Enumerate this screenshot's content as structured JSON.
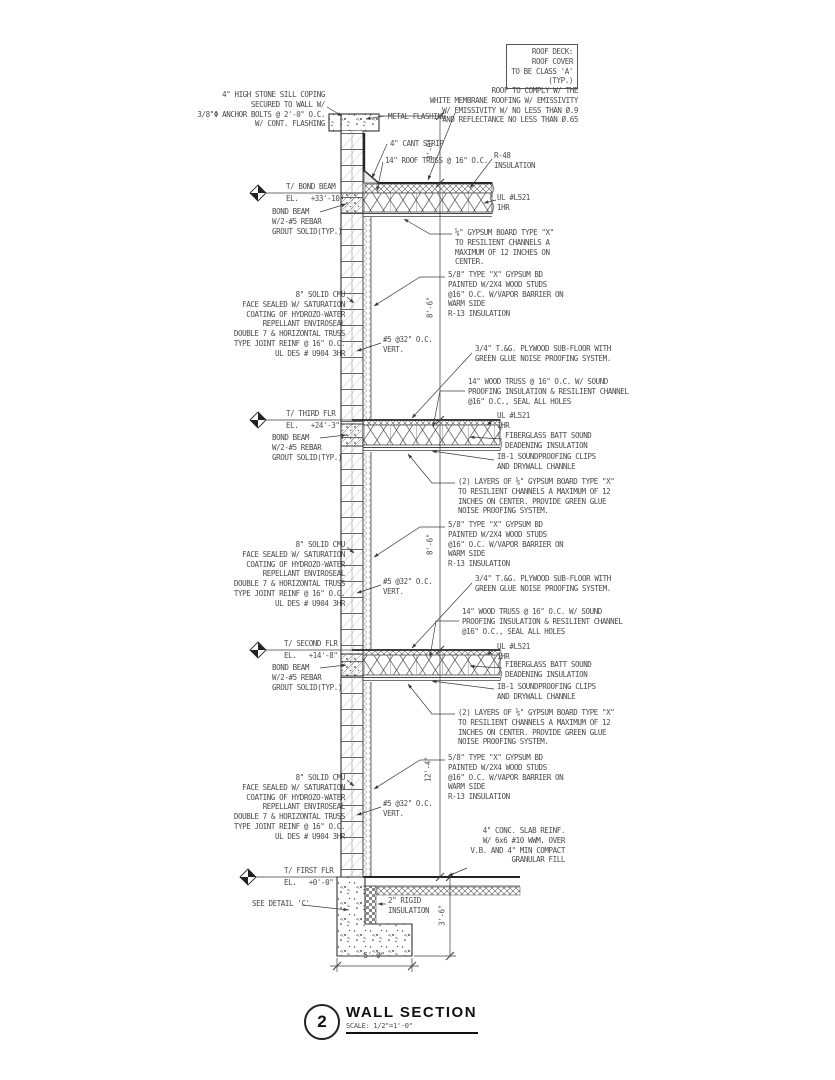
{
  "title_block": {
    "number": "2",
    "title": "WALL SECTION",
    "scale": "SCALE: 1/2\"=1'-0\""
  },
  "notes": {
    "roof_deck_box": "ROOF DECK:\nROOF COVER\nTO BE CLASS 'A'\n(TYP.)",
    "roof_comply": "ROOF TO COMPLY W/ THE\nWHITE MEMBRANE ROOFING W/ EMISSIVITY\nW/ EMISSIVITY W/ NO LESS THAN Ø.9\nAND REFLECTANCE NO LESS THAN Ø.65",
    "stone_sill": "4\" HIGH STONE SILL COPING\nSECURED TO WALL W/\n3/8\"Φ ANCHOR BOLTS @ 2'-0\" O.C.\nW/ CONT. FLASHING",
    "metal_flashing": "METAL FLASHING",
    "cant_strip": "4\" CANT STRIP",
    "roof_truss": "14\" ROOF TRUSS @ 16\" O.C.",
    "r48_insulation": "R-48\nINSULATION",
    "ul_rating": "UL #L521\n1HR",
    "gypsum_resilient": "⅝\" GYPSUM BOARD TYPE \"X\"\nTO RESILIENT CHANNELS A\nMAXIMUM OF 12 INCHES ON\nCENTER.",
    "gypsum_bd": "5/8\" TYPE \"X\" GYPSUM BD\nPAINTED W/2X4 WOOD STUDS\n@16\" O.C. W/VAPOR BARRIER ON\nWARM SIDE\nR-13 INSULATION",
    "cmu_wall": "8\" SOLID CMU\nFACE SEALED W/ SATURATION\nCOATING OF HYDROZO-WATER\nREPELLANT ENVIROSEAL\nDOUBLE 7 & HORIZONTAL TRUSS\nTYPE JOINT REINF @ 16\" O.C.\nUL DES # U904 3HR",
    "vert_rebar": "#5 @32\" O.C.\nVERT.",
    "plywood_subfloor": "3/4\" T.&G. PLYWOOD SUB-FLOOR WITH\nGREEN GLUE NOISE PROOFING SYSTEM.",
    "wood_truss": "14\" WOOD TRUSS @ 16\" O.C. W/ SOUND\nPROOFING INSULATION & RESILIENT CHANNEL\n@16\" O.C., SEAL ALL HOLES",
    "fiberglass_batt": "FIBERGLASS BATT SOUND\nDEADENING INSULATION",
    "ib1_clips": "IB-1 SOUNDPROOFING CLIPS\nAND DRYWALL CHANNLE",
    "two_layers_gypsum": "(2) LAYERS OF ⅝\" GYPSUM BOARD TYPE \"X\"\nTO RESILIENT CHANNELS A MAXIMUM OF 12\nINCHES ON CENTER. PROVIDE GREEN GLUE\nNOISE PROOFING SYSTEM.",
    "bond_beam": "BOND BEAM\nW/2-#5 REBAR\nGROUT SOLID(TYP.)",
    "conc_slab": "4\" CONC. SLAB REINF.\nW/ 6x6 #10 WWM. OVER\nV.B. AND 4\" MIN COMPACT\nGRANULAR FILL",
    "see_detail": "SEE DETAIL 'C'",
    "rigid_insulation": "2\" RIGID\nINSULATION"
  },
  "levels": {
    "bond_beam": {
      "label": "T/ BOND BEAM",
      "el": "EL.   +33'-10\""
    },
    "third": {
      "label": "T/ THIRD FLR",
      "el": "EL.   +24'-3\""
    },
    "second": {
      "label": "T/ SECOND FLR",
      "el": "EL.   +14'-8\""
    },
    "first": {
      "label": "T/ FIRST FLR",
      "el": "EL.   +0'-0\""
    }
  },
  "dimensions": {
    "parapet_height": "3'-0\"",
    "roof_to_third": "8'-6\"",
    "third_to_second": "8'-6\"",
    "second_to_first": "12'-4\"",
    "footing_width": "5'-0\"",
    "footing_depth": "3'-6\""
  },
  "colors": {
    "line": "#3c3c3c",
    "text": "#4a4a4a"
  }
}
